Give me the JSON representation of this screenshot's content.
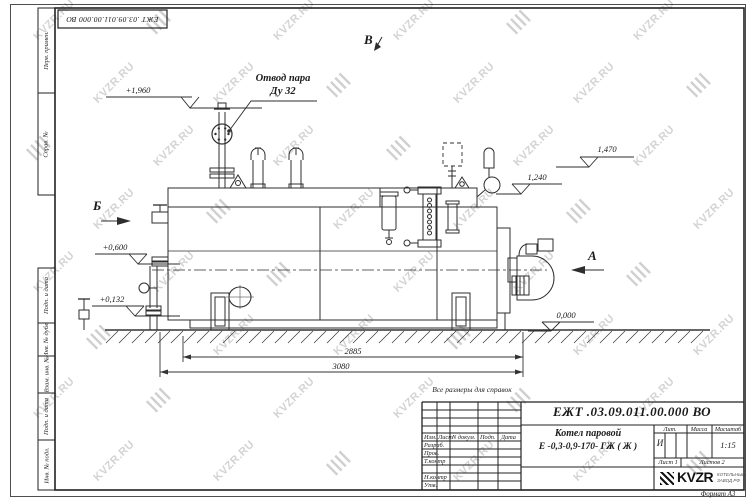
{
  "watermark": {
    "text": "KVZR.RU"
  },
  "top_stamp": {
    "number": "ЕЖТ .03.09.011.00.000 ВО"
  },
  "margin": {
    "cells": [
      "Перв. примен.",
      "Справ. №",
      "Подп. и дата",
      "Инв. № дубл.",
      "Взам. инв. №",
      "Подп. и дата",
      "Инв. № подл."
    ]
  },
  "drawing": {
    "steam_label_1": "Отвод пара",
    "steam_label_2": "Ду 32",
    "view_b": "Б",
    "view_a": "А",
    "view_v": "В",
    "elev_1960": "+1,960",
    "elev_0600": "+0,600",
    "elev_0132": "+0,132",
    "elev_1470": "1,470",
    "elev_1240": "1,240",
    "elev_0000": "0,000",
    "dim_length_inner": "2885",
    "dim_length_overall": "3080"
  },
  "note": "Все размеры для справок",
  "title_block": {
    "doc_number": "ЕЖТ .03.09.011.00.000  ВО",
    "product_name": "Котел паровой",
    "product_model": "Е -0,3-0,9-170- ГЖ ( Ж )",
    "col_izm": "Изм.",
    "col_list": "Лист",
    "col_ndoc": "N докум.",
    "col_podp": "Подп.",
    "col_data": "Дата",
    "row_razrab": "Разраб.",
    "row_prov": "Пров.",
    "row_tkontr": "Т.контр",
    "row_nkontr": "Н.контр",
    "row_utv": "Утв.",
    "lit_label": "Лит.",
    "mass_label": "Масса",
    "scale_label": "Масштаб",
    "lit_value": "И",
    "scale_value": "1:15",
    "sheet": "Лист 1",
    "sheets": "Листов 2",
    "logo_text": "KVZR",
    "logo_sub1": "КОТЕЛЬНЫЙ",
    "logo_sub2": "ЗАВОД.РФ",
    "format_note": "Формат А3"
  }
}
